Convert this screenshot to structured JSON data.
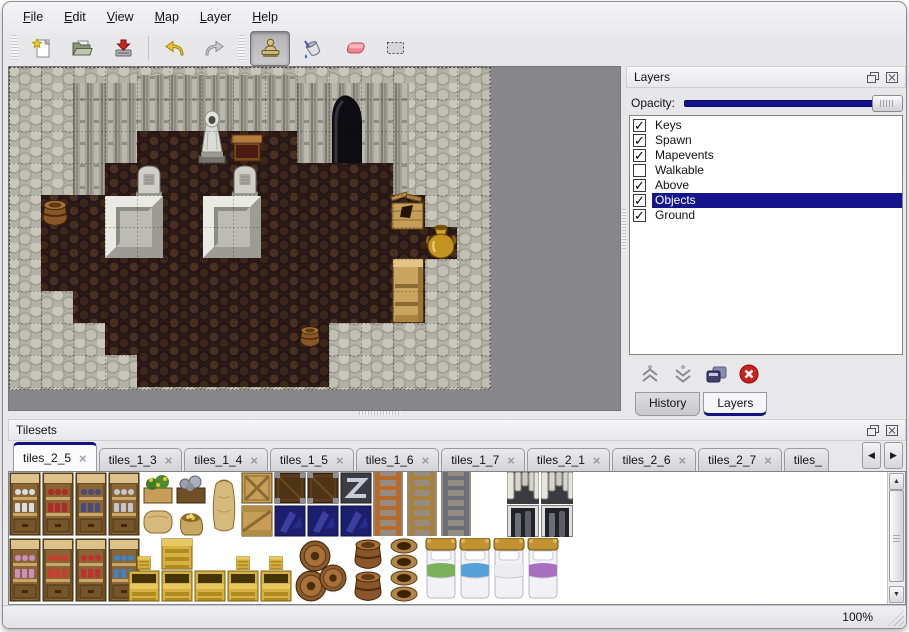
{
  "window": {
    "status_zoom": "100%"
  },
  "menu_bar": {
    "items": [
      {
        "label": "File"
      },
      {
        "label": "Edit"
      },
      {
        "label": "View"
      },
      {
        "label": "Map"
      },
      {
        "label": "Layer"
      },
      {
        "label": "Help"
      }
    ]
  },
  "toolbar": {
    "buttons": [
      {
        "icon": "new-file-icon",
        "active": false
      },
      {
        "icon": "open-icon",
        "active": false
      },
      {
        "icon": "save-icon",
        "active": false
      },
      {
        "icon": "undo-icon",
        "active": false
      },
      {
        "icon": "redo-icon",
        "active": false
      },
      {
        "icon": "stamp-tool-icon",
        "active": true
      },
      {
        "icon": "fill-tool-icon",
        "active": false
      },
      {
        "icon": "eraser-tool-icon",
        "active": false
      },
      {
        "icon": "select-tool-icon",
        "active": false
      }
    ]
  },
  "layers_panel": {
    "title": "Layers",
    "opacity_label": "Opacity:",
    "check_glyph": "✓",
    "layers": [
      {
        "label": "Keys",
        "checked": true,
        "selected": false
      },
      {
        "label": "Spawn",
        "checked": true,
        "selected": false
      },
      {
        "label": "Mapevents",
        "checked": true,
        "selected": false
      },
      {
        "label": "Walkable",
        "checked": false,
        "selected": false
      },
      {
        "label": "Above",
        "checked": true,
        "selected": false
      },
      {
        "label": "Objects",
        "checked": true,
        "selected": true
      },
      {
        "label": "Ground",
        "checked": true,
        "selected": false
      }
    ],
    "tabs": [
      {
        "label": "History",
        "active": false
      },
      {
        "label": "Layers",
        "active": true
      }
    ]
  },
  "tilesets_panel": {
    "title": "Tilesets",
    "close_glyph": "×",
    "scroll_left_glyph": "◀",
    "scroll_right_glyph": "▶",
    "scroll_up_glyph": "▲",
    "scroll_down_glyph": "▼",
    "tabs": [
      {
        "label": "tiles_2_5",
        "active": true
      },
      {
        "label": "tiles_1_3",
        "active": false
      },
      {
        "label": "tiles_1_4",
        "active": false
      },
      {
        "label": "tiles_1_5",
        "active": false
      },
      {
        "label": "tiles_1_6",
        "active": false
      },
      {
        "label": "tiles_1_7",
        "active": false
      },
      {
        "label": "tiles_2_1",
        "active": false
      },
      {
        "label": "tiles_2_6",
        "active": false
      },
      {
        "label": "tiles_2_7",
        "active": false
      },
      {
        "label": "tiles_",
        "active": false
      }
    ]
  },
  "colors": {
    "selection_blue": "#14148c",
    "opacity_fill": "#12128e",
    "canvas_gray": "#87878a"
  }
}
